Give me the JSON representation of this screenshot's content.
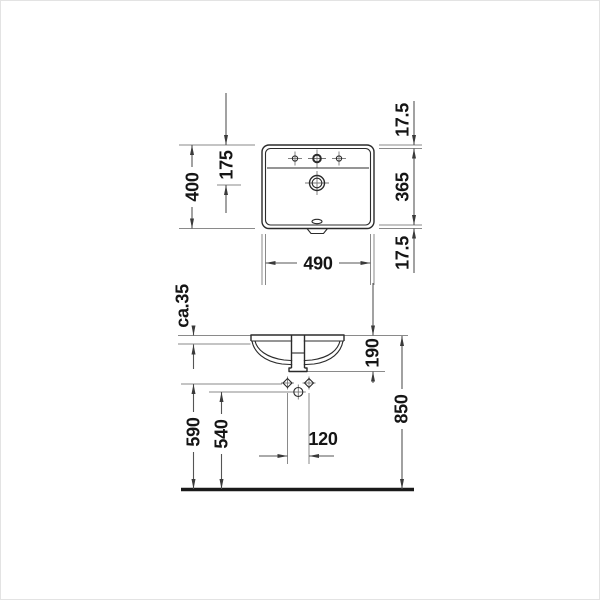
{
  "drawing": {
    "type": "washbasin installation technical drawing",
    "views": {
      "top": "plan view",
      "front": "front installation view"
    },
    "top_view": {
      "width": "490",
      "depth": "400",
      "drain_offset": "175",
      "rim_rear": "17.5",
      "basin_inner_depth": "365",
      "rim_front": "17.5"
    },
    "side_view": {
      "counter_thickness": "ca.35",
      "outlet_below_counter": "190",
      "fixing_height": "590",
      "supply_height": "540",
      "supply_spacing": "120",
      "rim_height": "850"
    },
    "line_colors": {
      "object": "#2b2b2b",
      "dimension": "#555555",
      "extension": "#8a8a8a",
      "floor": "#1a1a1a"
    }
  }
}
